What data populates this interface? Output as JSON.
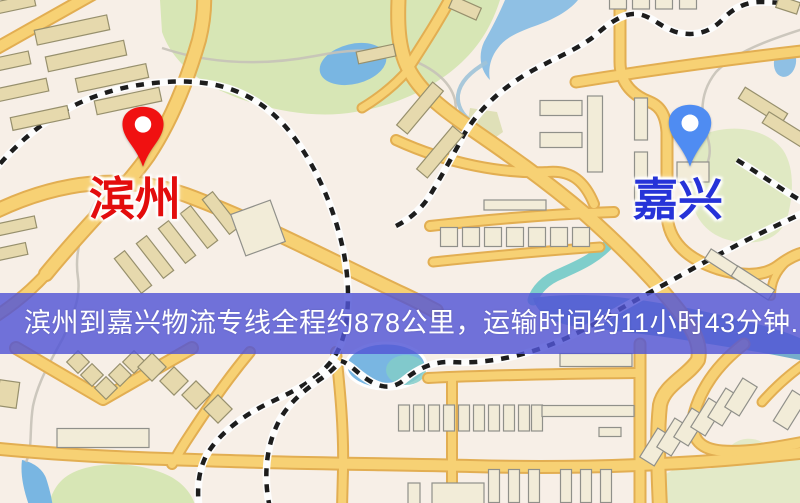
{
  "map": {
    "origin": {
      "label": "滨州",
      "pin_color": "#f01111",
      "label_color": "#e30d0d"
    },
    "destination": {
      "label": "嘉兴",
      "pin_color": "#4f8cf2",
      "label_color": "#2633d8"
    },
    "style": {
      "background": "#f7efe7",
      "road_color": "#f7d174",
      "road_casing": "#e2ae52",
      "park_color": "#d7e6b5",
      "water_color": "#79b6e2",
      "railway_color": "#1d1d1d",
      "building_fill": "#e6d9ad"
    }
  },
  "banner": {
    "text": "滨州到嘉兴物流专线全程约878公里，运输时间约11小时43分钟.",
    "background": "rgba(82,86,214,0.82)",
    "text_color": "#ffffff"
  }
}
